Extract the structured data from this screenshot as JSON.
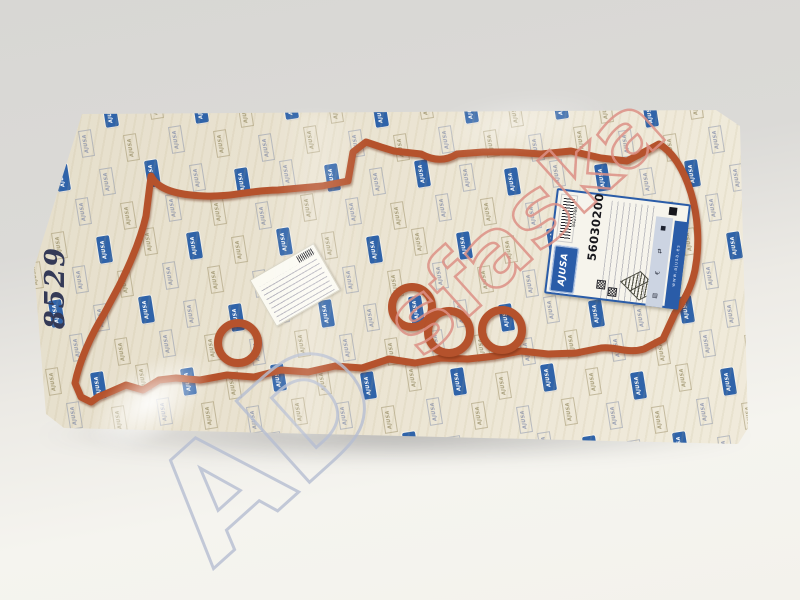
{
  "scene": {
    "background_top": "#d8d7d4",
    "background_bottom": "#f5f4ef"
  },
  "packaging": {
    "pattern_text": "AJUSA",
    "handwritten_number": "8529",
    "base_color": "#eae3d1",
    "chip_blue": "#2f63a9"
  },
  "label": {
    "brand": "AJUSA",
    "part_number": "56030200",
    "barcode_digits": "8427769",
    "band_text": "www.ajusa.es",
    "icon_glyphs": [
      "■",
      "⇄",
      "€",
      "▤"
    ],
    "icon_names": [
      "black-square",
      "transfer-arrows",
      "euro",
      "grid"
    ]
  },
  "gasket": {
    "color": "#b5522c"
  },
  "watermark": {
    "gray_text": "AD",
    "red_text": "sfaska",
    "gray_color": "#b6bed2",
    "red_color": "#dd9186"
  }
}
